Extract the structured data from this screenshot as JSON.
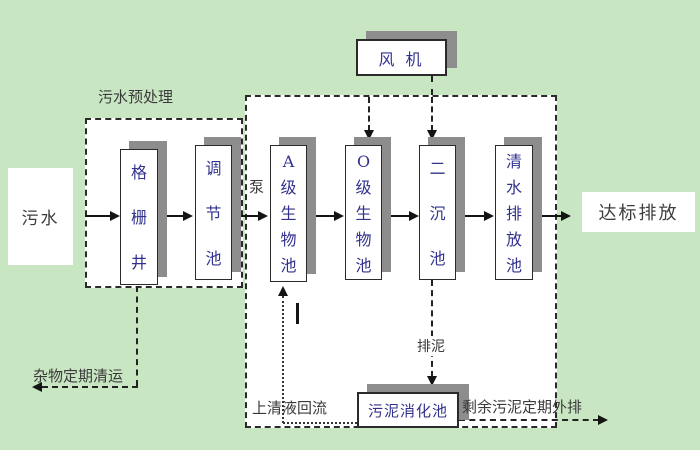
{
  "colors": {
    "background": "#c9e6c3",
    "box_fill": "#ffffff",
    "box_border": "#2a2a2a",
    "box_shadow": "#8d8d8d",
    "box_text": "#32328e",
    "label_text": "#3a3a3a",
    "line": "#141414"
  },
  "nodes": {
    "sewage": {
      "label": "污水"
    },
    "grid_well": {
      "label": "格\n栅\n井"
    },
    "regulation_tank": {
      "label": "调\n节\n池"
    },
    "a_bio_tank": {
      "label": "A\n级\n生\n物\n池"
    },
    "o_bio_tank": {
      "label": "O\n级\n生\n物\n池"
    },
    "secondary_sedimentation_tank": {
      "label": "二\n沉\n池"
    },
    "clear_water_discharge_tank": {
      "label": "清\n水\n排\n放\n池"
    },
    "blower": {
      "label": "风 机"
    },
    "sludge_digestion_tank": {
      "label": "污泥消化池"
    },
    "discharge": {
      "label": "达标排放"
    }
  },
  "labels": {
    "pretreatment_group": "污水预处理",
    "pump": "泵",
    "debris_removal": "杂物定期清运",
    "supernatant_return": "上清液回流",
    "sludge_discharge": "排泥",
    "excess_sludge_out": "剩余污泥定期外排"
  }
}
